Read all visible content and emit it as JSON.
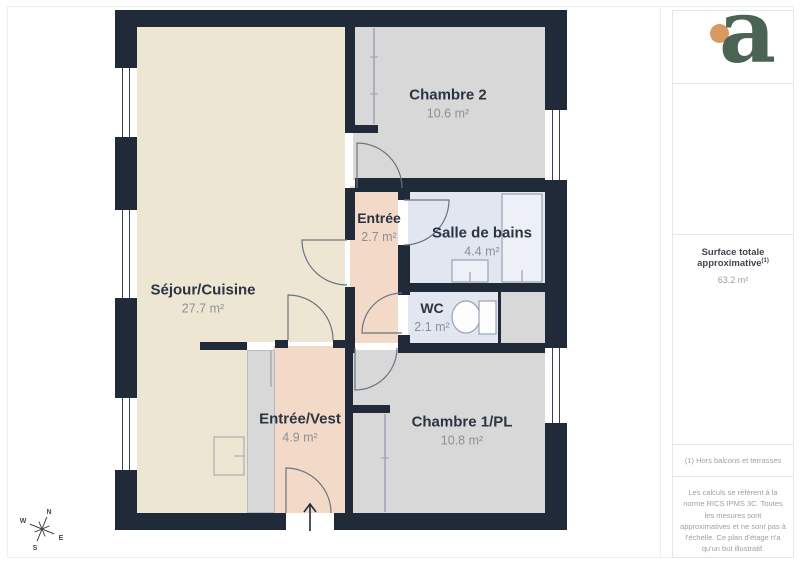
{
  "floorplan": {
    "wall_color": "#202a38",
    "closet_color": "#d8d8d8",
    "rooms": [
      {
        "id": "sejour",
        "label": "Séjour/Cuisine",
        "area": "27.7 m²",
        "color": "#ede6d2"
      },
      {
        "id": "chambre2",
        "label": "Chambre 2",
        "area": "10.6 m²",
        "color": "#d8d8d8"
      },
      {
        "id": "entree",
        "label": "Entrée",
        "area": "2.7 m²",
        "color": "#f3d9c8"
      },
      {
        "id": "salle_de_bains",
        "label": "Salle de bains",
        "area": "4.4 m²",
        "color": "#e1e6f0"
      },
      {
        "id": "wc",
        "label": "WC",
        "area": "2.1 m²",
        "color": "#e1e6f0"
      },
      {
        "id": "entree_vest",
        "label": "Entrée/Vest",
        "area": "4.9 m²",
        "color": "#f3d9c8"
      },
      {
        "id": "chambre1",
        "label": "Chambre 1/PL",
        "area": "10.8 m²",
        "color": "#d8d8d8"
      }
    ],
    "compass": {
      "n": "N",
      "e": "E",
      "s": "S",
      "w": "W"
    }
  },
  "sidebar": {
    "logo_letter": "a",
    "logo_colors": {
      "letter": "#4a6352",
      "dot": "#d89a62"
    },
    "surface_label": "Surface totale approximative",
    "surface_superscript": "(1)",
    "surface_value": "63.2 m²",
    "footnote": "(1) Hors balcons et terrasses",
    "disclaimer": "Les calculs se réfèrent à la norme RICS IPMS 3C. Toutes les mesures sont approximatives et ne sont pas à l'échelle. Ce plan d'étage n'a qu'un but illustratif.",
    "brand": "GIRAFFE",
    "brand_bold": "360"
  }
}
